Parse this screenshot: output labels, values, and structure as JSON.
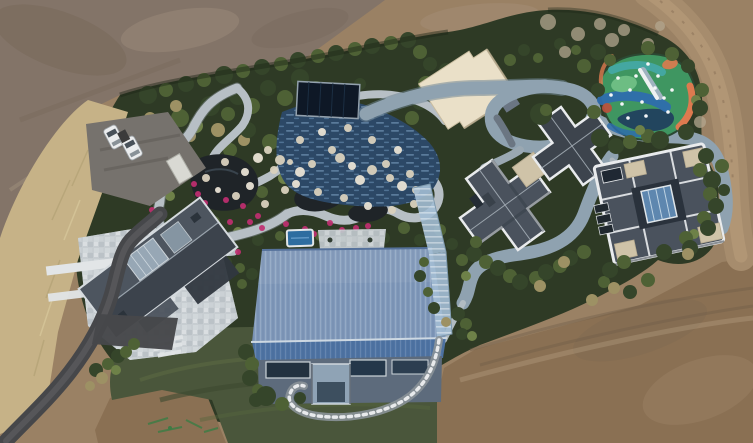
{
  "scene": {
    "type": "aerial-drone-photograph",
    "subject": "Landscaped private estate with ornamental water garden, pools, playground and modern houses surrounded by bare graded earth",
    "canvas": {
      "width": 753,
      "height": 443
    },
    "palette": {
      "dirt_gray": "#837468",
      "dirt_tan": "#9a8164",
      "dirt_brown": "#8a7053",
      "dirt_road": "#a68c6d",
      "dry_grass": "#c6b287",
      "hedge": "#2e3a25",
      "lawn": "#4a563b",
      "foliage_dark": "#35452a",
      "foliage_mid": "#4e6135",
      "foliage_light": "#6e8148",
      "foliage_tan": "#9d9164",
      "stone_path": "#b7bfc5",
      "pond": "#1f2428",
      "flower_magenta": "#c02f70",
      "rock_tan": "#d9d1bd",
      "pool_water": "#2c4866",
      "pool_cover": "#0e1826",
      "cream_roof": "#eae0c8",
      "track_road": "#8fa2b0",
      "asphalt": "#46474a",
      "slate_roof": "#4a525d",
      "slate_dark": "#3d444d",
      "white_trim": "#e9ebed",
      "tan_pad": "#cfc3a8",
      "skylight_blue": "#5e87af",
      "courtyard_stone": "#c7cdd1",
      "white_path": "#e2e5e7",
      "blue_roof_light": "#8099ba",
      "blue_roof_dark": "#4e73a3",
      "facade": "#5d6b7c",
      "window_dark": "#233240",
      "glass_walkway": "#a2bcd3",
      "play_green": "#3f9661",
      "play_blue": "#2e6dad",
      "play_teal": "#44a7a1",
      "play_orange": "#dd7a4f",
      "play_red": "#bd4f3c",
      "play_navy": "#1f3e5e",
      "car_white": "#ebedee",
      "parking_pad": "#76726d"
    },
    "labels": {
      "buildings": [
        "blue-standing-seam-gable-house",
        "slate-gable-house-with-stone-courtyard",
        "cross-plan-slate-roof-house",
        "square-slate-roof-house-with-skylight",
        "cream-flat-roof-pavilion",
        "dark-covered-pool-pavilion"
      ],
      "landscape": [
        "ornamental-garden",
        "dark-ponds",
        "winding-stone-paths",
        "magenta-flower-beds",
        "blue-tiled-pool",
        "multicolor-playground",
        "looping-track",
        "lawn",
        "hedge-boundary",
        "perimeter-dirt-road",
        "asphalt-driveway",
        "gravel-parking"
      ],
      "vehicle_count": 2
    },
    "shrubs": {
      "base": [
        [
          148,
          95,
          9,
          "d"
        ],
        [
          166,
          90,
          7,
          "m"
        ],
        [
          186,
          84,
          8,
          "d"
        ],
        [
          204,
          80,
          7,
          "m"
        ],
        [
          224,
          75,
          9,
          "d"
        ],
        [
          243,
          71,
          7,
          "m"
        ],
        [
          262,
          67,
          8,
          "d"
        ],
        [
          281,
          64,
          7,
          "m"
        ],
        [
          298,
          60,
          8,
          "d"
        ],
        [
          318,
          56,
          7,
          "m"
        ],
        [
          336,
          53,
          8,
          "d"
        ],
        [
          355,
          49,
          7,
          "m"
        ],
        [
          372,
          46,
          8,
          "d"
        ],
        [
          391,
          43,
          7,
          "m"
        ],
        [
          408,
          40,
          8,
          "d"
        ],
        [
          420,
          52,
          7,
          "m"
        ],
        [
          430,
          64,
          7,
          "d"
        ],
        [
          426,
          84,
          8,
          "m"
        ],
        [
          420,
          102,
          8,
          "d"
        ],
        [
          412,
          118,
          7,
          "m"
        ],
        [
          160,
          132,
          8,
          "d"
        ],
        [
          180,
          118,
          9,
          "m"
        ],
        [
          196,
          126,
          7,
          "l"
        ],
        [
          210,
          106,
          10,
          "d"
        ],
        [
          228,
          114,
          7,
          "m"
        ],
        [
          238,
          96,
          9,
          "d"
        ],
        [
          252,
          106,
          8,
          "m"
        ],
        [
          268,
          88,
          8,
          "d"
        ],
        [
          285,
          98,
          8,
          "m"
        ],
        [
          300,
          78,
          9,
          "d"
        ],
        [
          316,
          88,
          7,
          "m"
        ],
        [
          330,
          96,
          7,
          "d"
        ],
        [
          150,
          118,
          6,
          "t"
        ],
        [
          176,
          106,
          6,
          "t"
        ],
        [
          190,
          136,
          6,
          "t"
        ],
        [
          162,
          120,
          5,
          "l"
        ],
        [
          218,
          130,
          7,
          "t"
        ],
        [
          244,
          140,
          6,
          "t"
        ],
        [
          346,
          92,
          7,
          "m"
        ],
        [
          360,
          84,
          6,
          "d"
        ],
        [
          248,
          130,
          8,
          "d"
        ],
        [
          270,
          142,
          8,
          "m"
        ],
        [
          296,
          152,
          8,
          "d"
        ],
        [
          318,
          146,
          7,
          "m"
        ],
        [
          230,
          150,
          7,
          "m"
        ],
        [
          288,
          128,
          7,
          "d"
        ],
        [
          332,
          112,
          7,
          "d"
        ],
        [
          352,
          104,
          6,
          "m"
        ],
        [
          240,
          180,
          7,
          "d"
        ],
        [
          262,
          192,
          6,
          "m"
        ],
        [
          284,
          178,
          6,
          "l"
        ],
        [
          306,
          186,
          6,
          "d"
        ],
        [
          328,
          178,
          5,
          "m"
        ],
        [
          348,
          188,
          6,
          "d"
        ],
        [
          368,
          196,
          5,
          "m"
        ],
        [
          388,
          200,
          6,
          "d"
        ],
        [
          406,
          192,
          5,
          "m"
        ],
        [
          418,
          176,
          6,
          "d"
        ],
        [
          398,
          164,
          5,
          "m"
        ],
        [
          380,
          156,
          6,
          "d"
        ],
        [
          214,
          222,
          6,
          "m"
        ],
        [
          196,
          218,
          5,
          "d"
        ],
        [
          238,
          232,
          5,
          "l"
        ],
        [
          258,
          240,
          6,
          "d"
        ],
        [
          280,
          236,
          5,
          "m"
        ],
        [
          300,
          242,
          6,
          "d"
        ],
        [
          320,
          236,
          5,
          "m"
        ],
        [
          342,
          240,
          6,
          "d"
        ],
        [
          362,
          234,
          5,
          "m"
        ],
        [
          384,
          238,
          6,
          "d"
        ],
        [
          404,
          228,
          6,
          "m"
        ],
        [
          420,
          240,
          6,
          "d"
        ],
        [
          440,
          230,
          6,
          "m"
        ],
        [
          452,
          244,
          6,
          "d"
        ],
        [
          176,
          162,
          6,
          "m"
        ],
        [
          170,
          196,
          5,
          "l"
        ],
        [
          446,
          70,
          7,
          "d"
        ],
        [
          458,
          84,
          6,
          "m"
        ],
        [
          452,
          104,
          6,
          "d"
        ],
        [
          510,
          60,
          6,
          "m"
        ],
        [
          524,
          50,
          6,
          "d"
        ],
        [
          538,
          58,
          5,
          "m"
        ],
        [
          560,
          44,
          6,
          "d"
        ],
        [
          576,
          50,
          5,
          "m"
        ],
        [
          226,
          262,
          6,
          "d"
        ],
        [
          240,
          268,
          5,
          "m"
        ],
        [
          252,
          274,
          6,
          "d"
        ],
        [
          242,
          284,
          5,
          "m"
        ]
      ],
      "over": [
        [
          598,
          52,
          8,
          "d"
        ],
        [
          584,
          66,
          7,
          "m"
        ],
        [
          610,
          60,
          6,
          "m"
        ],
        [
          648,
          48,
          7,
          "m"
        ],
        [
          672,
          54,
          7,
          "m"
        ],
        [
          688,
          66,
          7,
          "d"
        ],
        [
          702,
          90,
          7,
          "m"
        ],
        [
          696,
          100,
          5,
          "l"
        ],
        [
          700,
          108,
          8,
          "d"
        ],
        [
          600,
          138,
          9,
          "d"
        ],
        [
          616,
          146,
          8,
          "d"
        ],
        [
          630,
          142,
          7,
          "m"
        ],
        [
          648,
          136,
          7,
          "m"
        ],
        [
          660,
          140,
          9,
          "d"
        ],
        [
          686,
          132,
          8,
          "d"
        ],
        [
          640,
          130,
          5,
          "l"
        ],
        [
          598,
          90,
          7,
          "d"
        ],
        [
          594,
          112,
          7,
          "m"
        ],
        [
          706,
          156,
          8,
          "d"
        ],
        [
          700,
          170,
          7,
          "m"
        ],
        [
          712,
          180,
          9,
          "d"
        ],
        [
          710,
          194,
          7,
          "m"
        ],
        [
          716,
          206,
          8,
          "d"
        ],
        [
          704,
          218,
          7,
          "m"
        ],
        [
          708,
          228,
          8,
          "d"
        ],
        [
          694,
          234,
          5,
          "l"
        ],
        [
          686,
          238,
          7,
          "m"
        ],
        [
          690,
          248,
          8,
          "d"
        ],
        [
          664,
          252,
          8,
          "d"
        ],
        [
          688,
          254,
          6,
          "t"
        ],
        [
          722,
          166,
          7,
          "m"
        ],
        [
          724,
          190,
          6,
          "d"
        ],
        [
          474,
          254,
          8,
          "d"
        ],
        [
          486,
          262,
          7,
          "m"
        ],
        [
          498,
          268,
          8,
          "d"
        ],
        [
          510,
          276,
          7,
          "m"
        ],
        [
          520,
          282,
          8,
          "d"
        ],
        [
          536,
          278,
          7,
          "m"
        ],
        [
          546,
          272,
          8,
          "d"
        ],
        [
          560,
          266,
          7,
          "m"
        ],
        [
          570,
          258,
          8,
          "d"
        ],
        [
          584,
          252,
          7,
          "m"
        ],
        [
          604,
          282,
          6,
          "m"
        ],
        [
          610,
          270,
          8,
          "d"
        ],
        [
          624,
          262,
          7,
          "m"
        ],
        [
          564,
          262,
          6,
          "t"
        ],
        [
          540,
          286,
          6,
          "t"
        ],
        [
          592,
          300,
          6,
          "t"
        ],
        [
          614,
          288,
          6,
          "t"
        ],
        [
          630,
          292,
          7,
          "d"
        ],
        [
          648,
          280,
          7,
          "m"
        ],
        [
          476,
          242,
          6,
          "m"
        ],
        [
          462,
          260,
          6,
          "m"
        ],
        [
          466,
          276,
          5,
          "l"
        ],
        [
          246,
          352,
          8,
          "d"
        ],
        [
          252,
          364,
          7,
          "m"
        ],
        [
          250,
          378,
          8,
          "d"
        ],
        [
          258,
          390,
          6,
          "m"
        ],
        [
          256,
          400,
          7,
          "d"
        ],
        [
          458,
          314,
          7,
          "d"
        ],
        [
          466,
          324,
          6,
          "m"
        ],
        [
          462,
          334,
          6,
          "d"
        ],
        [
          472,
          336,
          5,
          "l"
        ],
        [
          446,
          322,
          5,
          "t"
        ],
        [
          266,
          396,
          10,
          "d"
        ],
        [
          282,
          404,
          7,
          "m"
        ],
        [
          300,
          398,
          6,
          "d"
        ],
        [
          118,
          356,
          7,
          "d"
        ],
        [
          108,
          364,
          6,
          "m"
        ],
        [
          96,
          370,
          7,
          "d"
        ],
        [
          126,
          352,
          6,
          "m"
        ],
        [
          102,
          378,
          6,
          "t"
        ],
        [
          90,
          386,
          5,
          "t"
        ],
        [
          116,
          370,
          5,
          "l"
        ],
        [
          134,
          344,
          6,
          "m"
        ],
        [
          424,
          262,
          5,
          "m"
        ],
        [
          420,
          276,
          6,
          "d"
        ],
        [
          428,
          292,
          5,
          "m"
        ],
        [
          434,
          308,
          6,
          "d"
        ],
        [
          541,
          114,
          11,
          "d"
        ],
        [
          546,
          110,
          6,
          "m"
        ]
      ]
    },
    "bare_trees": [
      [
        548,
        22,
        8
      ],
      [
        578,
        34,
        7
      ],
      [
        612,
        40,
        7
      ],
      [
        648,
        44,
        6
      ],
      [
        688,
        92,
        7
      ],
      [
        700,
        122,
        6
      ],
      [
        565,
        52,
        6
      ],
      [
        624,
        30,
        6
      ],
      [
        660,
        26,
        5
      ],
      [
        600,
        24,
        6
      ]
    ],
    "flowers": [
      [
        185,
        162
      ],
      [
        194,
        184
      ],
      [
        205,
        203
      ],
      [
        243,
        206
      ],
      [
        230,
        222
      ],
      [
        262,
        228
      ],
      [
        305,
        229
      ],
      [
        330,
        223
      ],
      [
        356,
        228
      ],
      [
        170,
        148
      ],
      [
        152,
        210
      ],
      [
        217,
        233
      ],
      [
        238,
        252
      ],
      [
        226,
        200
      ],
      [
        258,
        216
      ],
      [
        286,
        224
      ],
      [
        314,
        234
      ],
      [
        182,
        172
      ],
      [
        198,
        194
      ],
      [
        250,
        222
      ],
      [
        342,
        230
      ],
      [
        368,
        226
      ]
    ],
    "rocks": [
      [
        258,
        158,
        5
      ],
      [
        268,
        150,
        4
      ],
      [
        280,
        160,
        5
      ],
      [
        300,
        172,
        5
      ],
      [
        312,
        164,
        4
      ],
      [
        340,
        158,
        5
      ],
      [
        352,
        166,
        4
      ],
      [
        372,
        170,
        5
      ],
      [
        390,
        178,
        4
      ],
      [
        402,
        186,
        5
      ],
      [
        416,
        190,
        4
      ],
      [
        300,
        140,
        4
      ],
      [
        322,
        132,
        4
      ],
      [
        348,
        128,
        4
      ],
      [
        372,
        140,
        4
      ],
      [
        398,
        150,
        4
      ],
      [
        285,
        190,
        4
      ],
      [
        265,
        204,
        4
      ],
      [
        245,
        172,
        4
      ],
      [
        225,
        162,
        4
      ],
      [
        332,
        150,
        4
      ],
      [
        360,
        180,
        5
      ],
      [
        386,
        164,
        4
      ],
      [
        410,
        174,
        4
      ],
      [
        296,
        184,
        4
      ],
      [
        318,
        192,
        4
      ],
      [
        344,
        198,
        4
      ],
      [
        368,
        206,
        4
      ],
      [
        392,
        210,
        4
      ],
      [
        414,
        204,
        4
      ],
      [
        250,
        186,
        4
      ],
      [
        236,
        196,
        4
      ],
      [
        206,
        178,
        4
      ],
      [
        218,
        190,
        3
      ],
      [
        274,
        170,
        4
      ],
      [
        290,
        162,
        3
      ]
    ],
    "playground_dots": [
      [
        618,
        78
      ],
      [
        630,
        90
      ],
      [
        642,
        102
      ],
      [
        655,
        88
      ],
      [
        664,
        98
      ],
      [
        648,
        64
      ],
      [
        668,
        112
      ],
      [
        628,
        118
      ],
      [
        611,
        95
      ],
      [
        672,
        90
      ],
      [
        636,
        76
      ],
      [
        658,
        76
      ],
      [
        622,
        104
      ],
      [
        646,
        116
      ]
    ],
    "cars": [
      {
        "x": 107,
        "y": 126,
        "angle": -28
      },
      {
        "x": 125,
        "y": 137,
        "angle": -28
      }
    ]
  }
}
